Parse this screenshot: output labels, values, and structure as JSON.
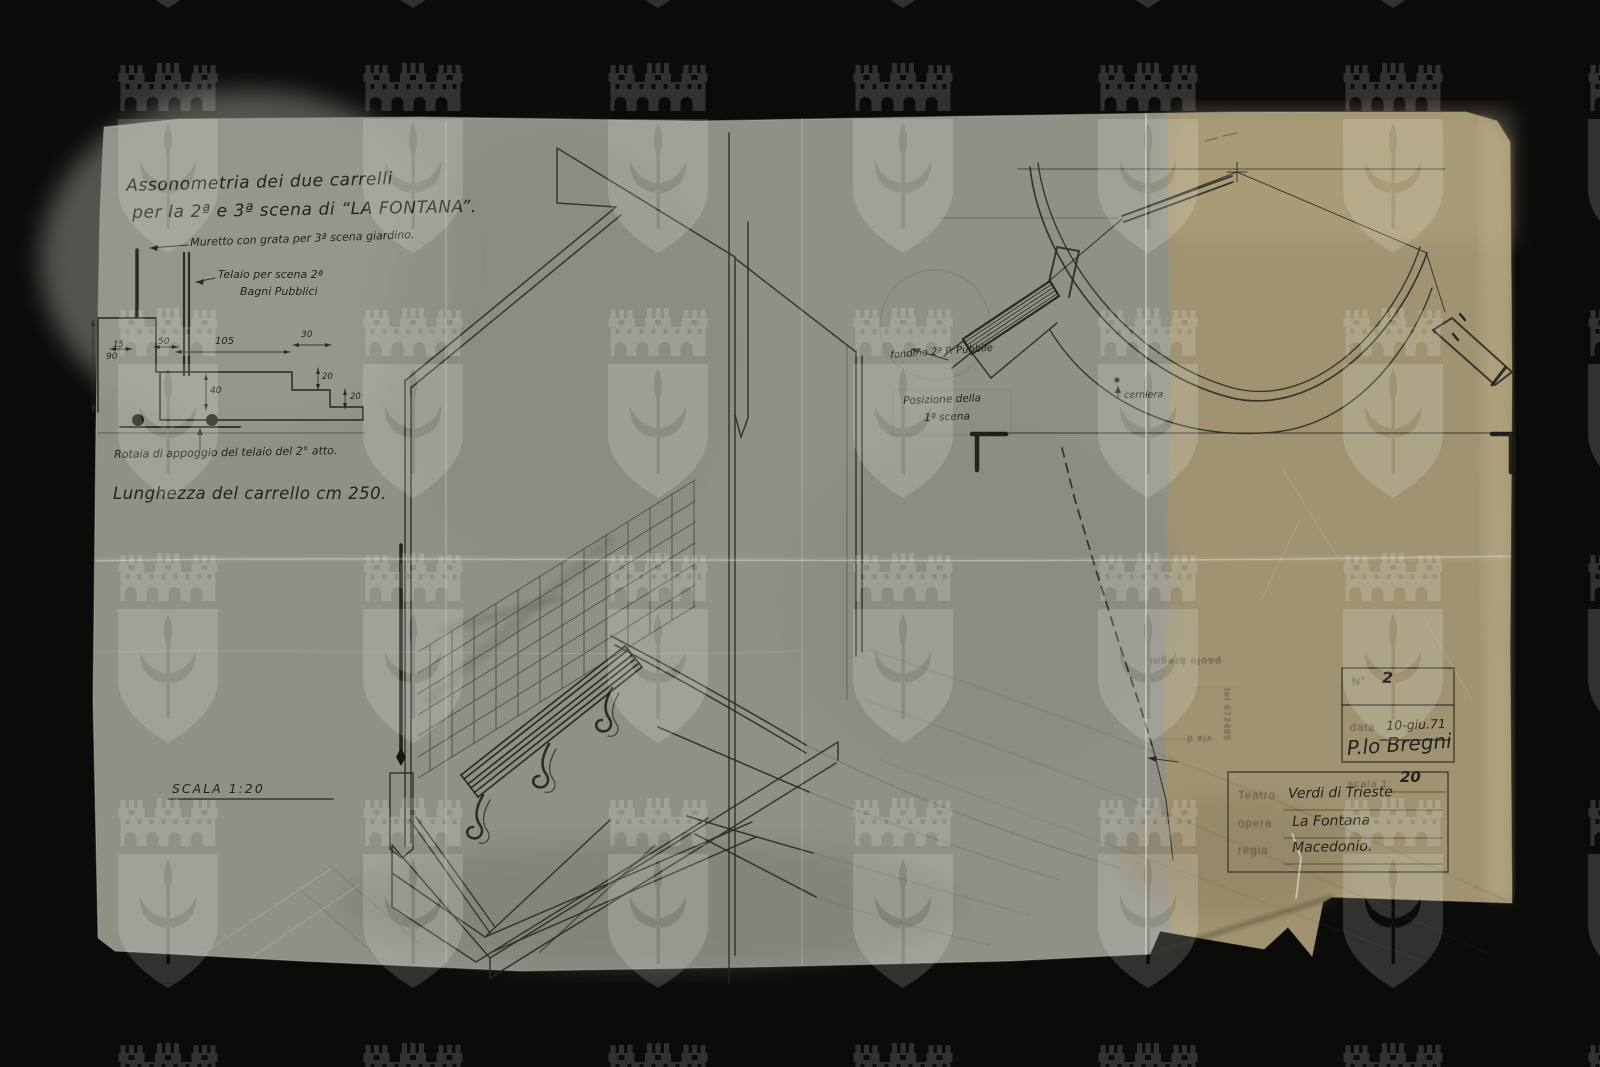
{
  "annotations": {
    "title_line1": "Assonometria dei due carrelli",
    "title_line2": "per la 2ª e 3ª scena di “LA FONTANA”.",
    "muretto": "Muretto con grata per 3ª scena giardino.",
    "telaio_1": "Telaio per scena 2ª",
    "telaio_2": "Bagni Pubblici",
    "rotaia": "Rotaia di appoggio del telaio del 2° atto.",
    "lunghezza": "Lunghezza del carrello cm 250.",
    "scala": "SCALA 1:20",
    "fondino": "fondino 2ª P. Pubbile",
    "posizione_1": "Posizione della",
    "posizione_2": "1ª scena",
    "cerniera": "cerniera"
  },
  "dimensions": {
    "d15": "15",
    "d50": "50",
    "d105": "105",
    "d30": "30",
    "d90": "90",
    "d40": "40",
    "d20a": "20",
    "d20b": "20"
  },
  "stamps": {
    "number_label": "N°",
    "number_value": "2",
    "date_label": "data",
    "date_value": "10-giu.71",
    "signature": "P.lo Bregni",
    "maker_name": "paolo bregni",
    "maker_extra": "·· ·········",
    "maker_address": "via d·······",
    "maker_phone": "tel 672485"
  },
  "title_block": {
    "scala_label": "scala 1:",
    "scala_value": "20",
    "rows": [
      {
        "label": "Teatro",
        "value": "Verdi di Trieste"
      },
      {
        "label": "opera",
        "value": "La Fontana"
      },
      {
        "label": "regia",
        "value": "Macedonio."
      }
    ]
  },
  "colors": {
    "background": "#0b0b09",
    "paper_gray": "#8f9086",
    "paper_tan": "#a2946d",
    "ink": "#2a2a22",
    "watermark": "#ffffff"
  }
}
